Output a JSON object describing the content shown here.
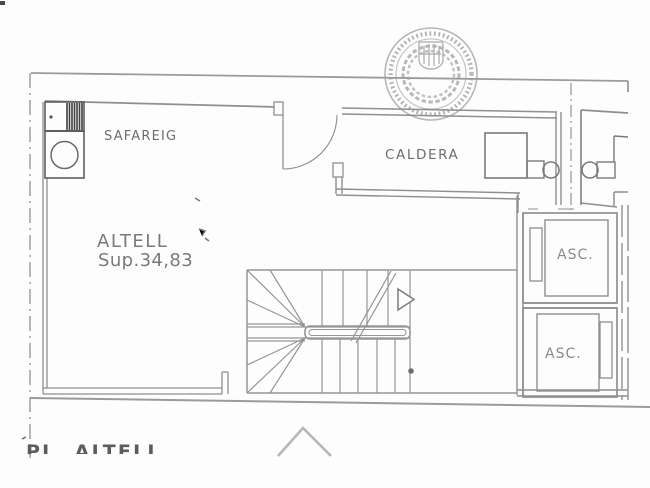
{
  "plan": {
    "rooms": {
      "safareig": {
        "label": "SAFAREIG"
      },
      "caldera": {
        "label": "CALDERA"
      },
      "altell": {
        "label": "ALTELL",
        "area_label": "Sup.34,83"
      },
      "elevator_top": {
        "label": "ASC."
      },
      "elevator_bottom": {
        "label": "ASC."
      }
    },
    "title_partial": "PL. ALTELL"
  },
  "colors": {
    "background": "#fdfdfd",
    "boundary_line": "#9b9b9b",
    "wall_line": "#8f8f8f",
    "stair_line": "#969696",
    "fixture_line": "#5e5e5e",
    "label_text": "#6e6e6e",
    "seal": "#ababab"
  }
}
